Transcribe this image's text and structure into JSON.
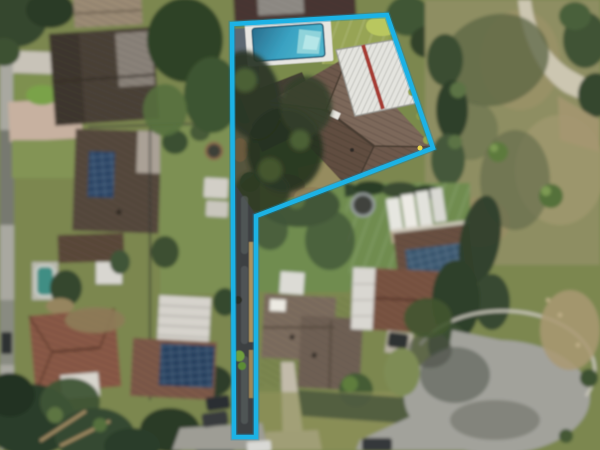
{
  "meta": {
    "width": 600,
    "height": 450,
    "image_type": "aerial-drone-photograph",
    "description": "Overhead drone photo of a suburban battle-axe property highlighted with a cyan boundary outline: pool and tiled-roof house at top, long narrow driveway strip down to the street, neighbouring houses, park with footpath top-right, cul-de-sac bottom-right"
  },
  "boundary": {
    "points": "232,24 387,15 433,148 256,216 256,437 234,437",
    "color": "#1cb2e5",
    "glow_color": "#0e85b5",
    "marker_color": "#f2dd4e"
  },
  "colors": {
    "base_ground": "#7c874f",
    "lot_lawn": "#7a8a4c",
    "bright_lawn": "#97a455",
    "park_grass": "#8e8e62",
    "neighbor_lawn": "#6f8c4f",
    "pool_water": "#3aa2c2",
    "pool_water_deep": "#2a6d8c",
    "pool_steps": "#8fd3da",
    "pool_deck": "#e7e6e1",
    "roof_main": "#6d594b",
    "roof_dark_brown": "#4c4238",
    "roof_terracotta": "#8a5a47",
    "roof_grey_brown": "#7d6d5f",
    "patio_white": "#e4e4df",
    "patio_beam_red": "#a63b31",
    "solar_panel": "#3a566e",
    "asphalt_driveway": "#3e4143",
    "road": "#a2a29b",
    "footpath": "#ccc6b1",
    "paver_drive": "#c7b1a0",
    "tree_dark": "#2f402b",
    "tree_mid": "#44583a",
    "dirt": "#a69671",
    "fence_tan": "#b1975f",
    "car_dark": "#2e3032",
    "car_white": "#d9d9d5"
  },
  "features": [
    "highlighted-property-boundary",
    "swimming-pool",
    "pool-deck",
    "main-house-tiled-roof",
    "white-ribbed-patio-roof",
    "red-patio-beam",
    "garden-shade-trees",
    "narrow-driveway-strip",
    "timber-fence-line",
    "neighbor-houses",
    "solar-panel-arrays",
    "round-spa",
    "trampoline",
    "park-with-curved-footpath",
    "cul-de-sac-road",
    "parked-cars",
    "tree-clusters-and-lawns"
  ]
}
